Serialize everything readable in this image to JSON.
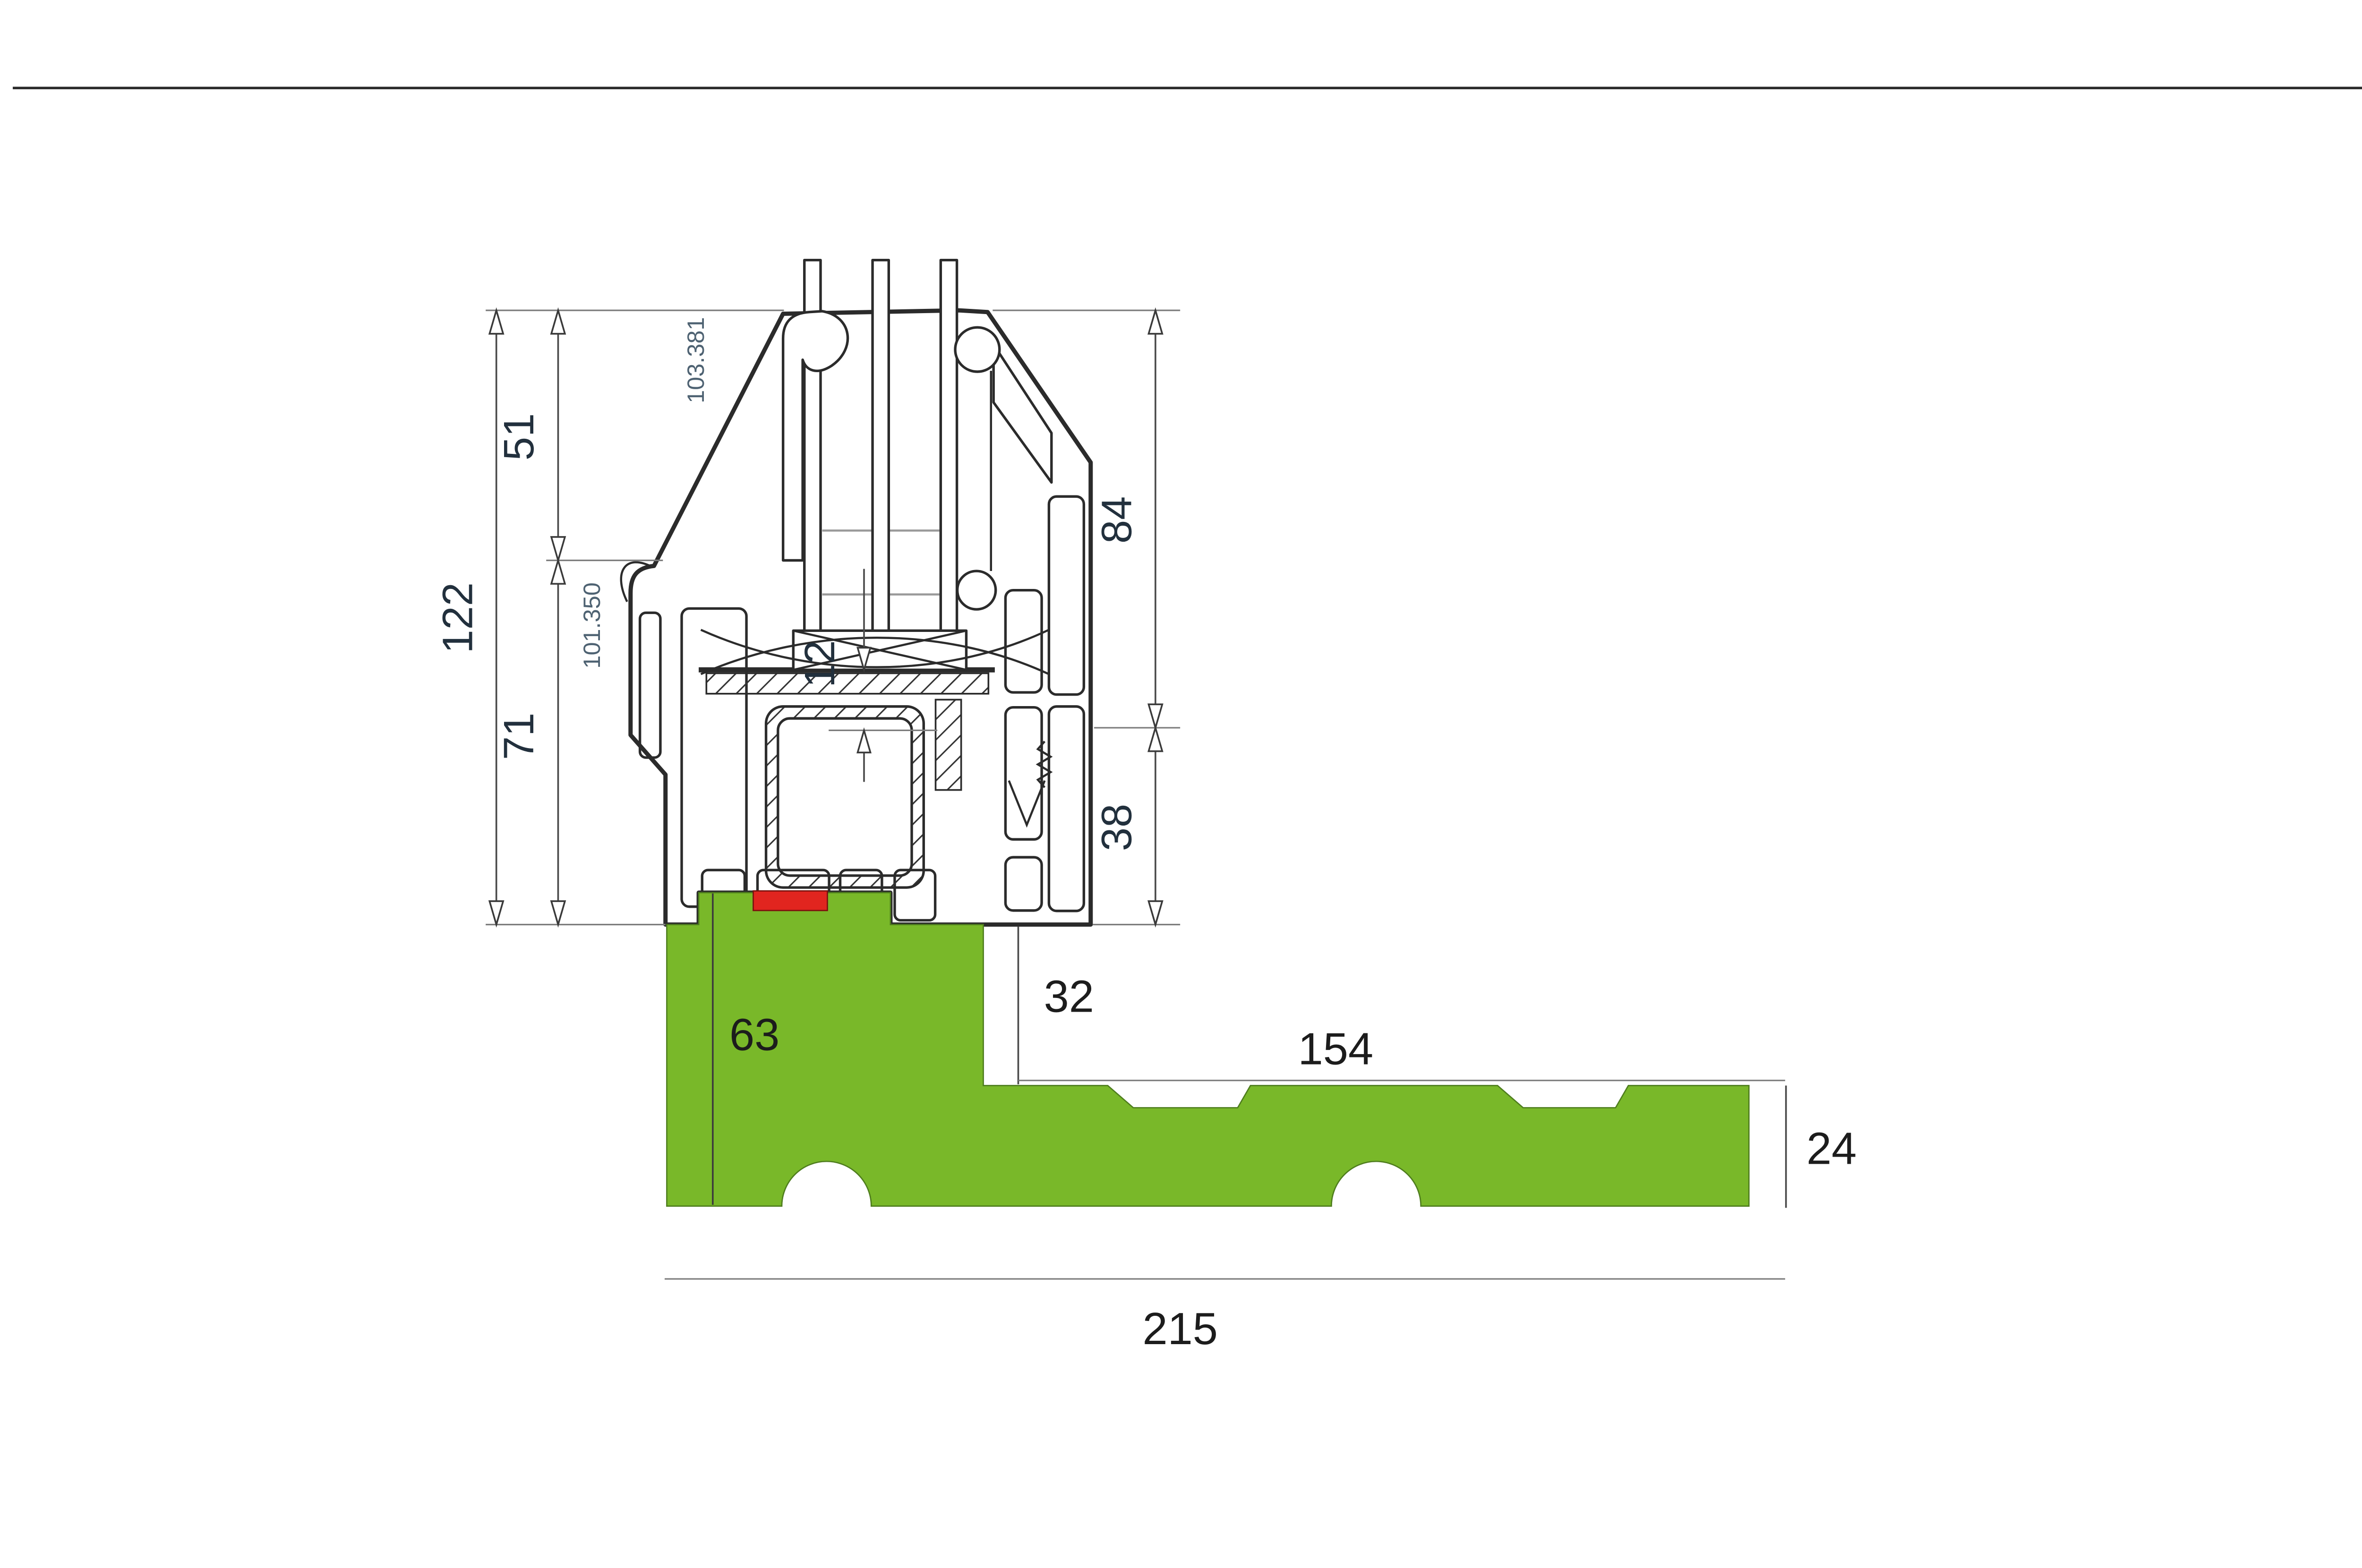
{
  "drawing": {
    "type": "window-sill-profile-cross-section",
    "colors": {
      "sill_green": "#79b829",
      "marker_red": "#e1251f",
      "profile_line": "#2b2b2b",
      "dimension_line": "#4a4a4a",
      "article_text": "#4e6272",
      "background": "#ffffff"
    },
    "article_numbers": {
      "upper_profile": "103.381",
      "main_profile": "101.350"
    },
    "dimensions": {
      "left_total": "122",
      "left_upper": "51",
      "left_lower": "71",
      "right_upper": "84",
      "right_lower": "38",
      "rebate_step": "12",
      "sill_upstand": "32",
      "sill_column_width": "63",
      "sill_leg_length": "154",
      "sill_leg_thickness": "24",
      "sill_total_width": "215"
    }
  }
}
